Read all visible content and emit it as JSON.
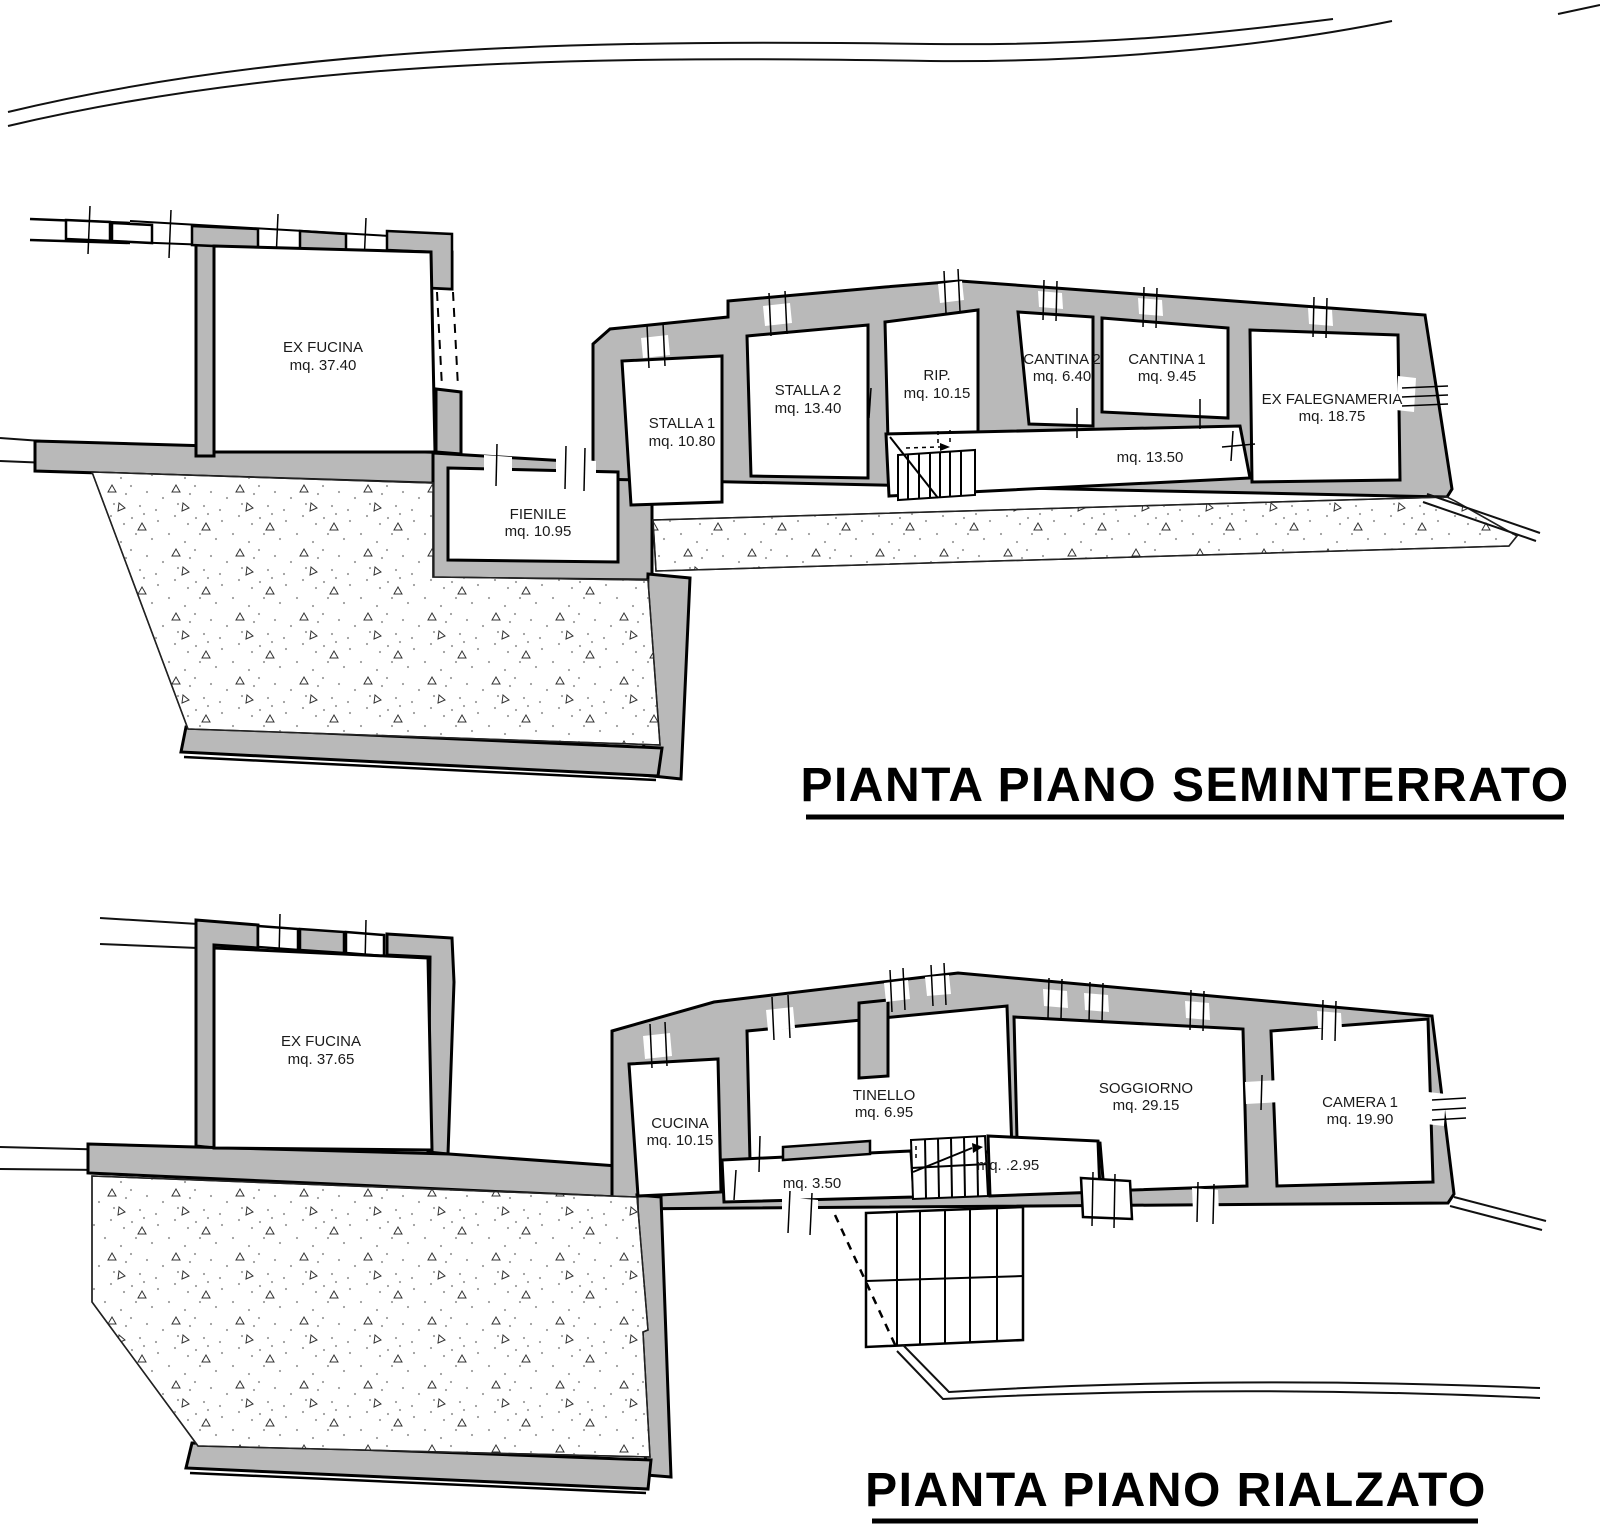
{
  "drawing": {
    "colors": {
      "background": "#ffffff",
      "wall_fill": "#b9b9b9",
      "line": "#000000",
      "stipple_dot": "#9e9e9e"
    },
    "plans": [
      {
        "id": "seminterrato",
        "title": "PIANTA PIANO SEMINTERRATO",
        "rooms": [
          {
            "name": "EX FUCINA",
            "area": "mq. 37.40"
          },
          {
            "name": "STALLA 1",
            "area": "mq. 10.80"
          },
          {
            "name": "STALLA 2",
            "area": "mq. 13.40"
          },
          {
            "name": "RIP.",
            "area": "mq. 10.15"
          },
          {
            "name": "CANTINA 2",
            "area": "mq. 6.40"
          },
          {
            "name": "CANTINA 1",
            "area": "mq. 9.45"
          },
          {
            "name": "EX FALEGNAMERIA",
            "area": "mq. 18.75"
          },
          {
            "name": "FIENILE",
            "area": "mq. 10.95"
          }
        ],
        "corridor_area": "mq. 13.50"
      },
      {
        "id": "rialzato",
        "title": "PIANTA PIANO RIALZATO",
        "rooms": [
          {
            "name": "EX FUCINA",
            "area": "mq. 37.65"
          },
          {
            "name": "CUCINA",
            "area": "mq. 10.15"
          },
          {
            "name": "TINELLO",
            "area": "mq. 6.95"
          },
          {
            "name": "SOGGIORNO",
            "area": "mq. 29.15"
          },
          {
            "name": "CAMERA 1",
            "area": "mq. 19.90"
          }
        ],
        "hall_area": "mq. 3.50",
        "landing_area": "mq. .2.95"
      }
    ]
  }
}
